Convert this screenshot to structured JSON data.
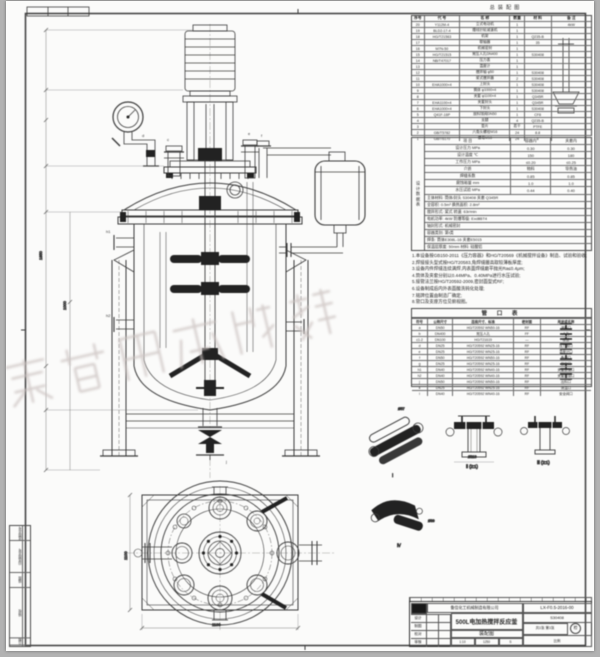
{
  "header": {
    "doc_label": "总装配图"
  },
  "watermark": {
    "text": "威海化工机械",
    "color": "#cbc2c0"
  },
  "left_strip": {
    "rows": [
      "底图总号",
      "旧底图总号",
      "描图",
      "描校",
      "日期"
    ]
  },
  "parts_list": {
    "headers": [
      "序号",
      "代  号",
      "名   称",
      "数量",
      "材 料",
      "备 注"
    ],
    "rows": [
      [
        "20",
        "Y112M-4",
        "立式电动机",
        "1",
        "",
        "4kW"
      ],
      [
        "19",
        "BLD2-17-4",
        "摆线针轮减速机",
        "1",
        "",
        ""
      ],
      [
        "18",
        "HG/T21563",
        "机架",
        "1",
        "Q235-B",
        ""
      ],
      [
        "17",
        "",
        "联轴器",
        "1",
        "35",
        ""
      ],
      [
        "16",
        "M7N-50",
        "机械密封",
        "1",
        "",
        ""
      ],
      [
        "15",
        "HG/T21515",
        "常压人孔DN400",
        "1",
        "S30408",
        ""
      ],
      [
        "14",
        "NB/T47017",
        "压力表",
        "1",
        "",
        ""
      ],
      [
        "13",
        "",
        "温度计",
        "1",
        "",
        ""
      ],
      [
        "12",
        "",
        "搅拌轴 φ50",
        "1",
        "S30408",
        ""
      ],
      [
        "11",
        "",
        "桨式搅拌器",
        "2",
        "S30408",
        ""
      ],
      [
        "10",
        "EHA1000×4",
        "上封头",
        "1",
        "S30408",
        ""
      ],
      [
        "9",
        "",
        "筒体 φ1000×4",
        "1",
        "S30408",
        ""
      ],
      [
        "8",
        "",
        "夹套 φ1100×4",
        "1",
        "Q345R",
        ""
      ],
      [
        "7",
        "EHA1100×4",
        "夹套封头",
        "1",
        "Q345R",
        ""
      ],
      [
        "6",
        "EHA1000×4",
        "下封头",
        "1",
        "S30408",
        ""
      ],
      [
        "5",
        "Q41F-16P",
        "放料球阀DN50",
        "1",
        "CF8",
        ""
      ],
      [
        "4",
        "",
        "支腿",
        "4",
        "Q235-B",
        ""
      ],
      [
        "3",
        "",
        "垫片",
        "若干",
        "PTFE",
        ""
      ],
      [
        "2",
        "GB/T5782",
        "六角头螺栓M16",
        "24",
        "8.8",
        ""
      ],
      [
        "1",
        "GB/T6170",
        "螺母M16",
        "24",
        "8",
        ""
      ]
    ]
  },
  "design_table": {
    "title": "设计数据表",
    "pairs": [
      [
        "项 目",
        "容器内",
        "夹套内"
      ],
      [
        "设计压力 MPa",
        "0.30",
        "0.30"
      ],
      [
        "设计温度 ℃",
        "150",
        "180"
      ],
      [
        "工作压力 MPa",
        "≤0.20",
        "≤0.25"
      ],
      [
        "介质",
        "物料",
        "导热油"
      ],
      [
        "焊缝系数",
        "0.85",
        "0.85"
      ],
      [
        "腐蚀裕量 mm",
        "1.0",
        "1.0"
      ],
      [
        "水压试验 MPa",
        "0.44",
        "0.40"
      ]
    ],
    "lines": [
      "主体材料: 筒体/封头 S30408  夹套 Q345R",
      "全容积: 0.5m³   换热面积: 2.8m²",
      "搅拌形式: 桨式   转速: 63r/min",
      "电机功率: 4kW   防爆等级: ExdⅡBT4",
      "轴封形式: 机械密封",
      "容器类别: 第Ⅰ类",
      "焊条: 筒体E308L-16  夹套E5015",
      "保温层厚度: 50mm  材料: 硅酸铝"
    ]
  },
  "tech_requirements": {
    "lines": [
      "1.本设备按GB150-2011《压力容器》和HG/T20569《机械搅拌设备》制造、试验和验收;",
      "2.焊接接头型式按HG/T20583,角焊缝腰高取较薄板厚度;",
      "3.设备内件焊缝连续满焊,内表面焊缝磨平抛光Ra≤0.4μm;",
      "4.筒体及夹套分别以0.44MPa、0.40MPa进行水压试验;",
      "5.接管法兰按HG/T20592-2009,密封面型式RF;",
      "6.设备制成后内外表面酸洗钝化处理;",
      "7.铭牌位置由制造厂确定;",
      "8.管口及支座方位见俯视图。"
    ]
  },
  "nozzle_table": {
    "title": "管 口 表",
    "headers": [
      "符号",
      "公称尺寸",
      "连接尺寸、标准",
      "密封面",
      "用途或名称"
    ],
    "rows": [
      [
        "a",
        "DN50",
        "HG/T20592 WN50-16",
        "RF",
        "进料口"
      ],
      [
        "b",
        "DN400",
        "常压人孔",
        "FF",
        "人孔"
      ],
      [
        "c1-2",
        "DN100",
        "HG/T21619",
        "—",
        "视镜"
      ],
      [
        "d",
        "DN25",
        "HG/T20592 WN25-16",
        "RF",
        "压力表口"
      ],
      [
        "e",
        "DN25",
        "HG/T20592 WN25-16",
        "RF",
        "温度计口"
      ],
      [
        "f",
        "DN50",
        "HG/T20592 WN50-16",
        "RF",
        "备用口"
      ],
      [
        "g",
        "DN25",
        "HG/T20592 WN25-16",
        "RF",
        "放空口"
      ],
      [
        "h1",
        "DN40",
        "HG/T20592 WN40-16",
        "RF",
        "夹套进油口"
      ],
      [
        "h2",
        "DN40",
        "HG/T20592 WN40-16",
        "RF",
        "夹套出油口"
      ],
      [
        "j",
        "DN50",
        "HG/T20592 WN50-16",
        "RF",
        "出料口"
      ],
      [
        "k",
        "DN25",
        "HG/T20592 WN25-16",
        "RF",
        "测温口"
      ],
      [
        "l",
        "DN40",
        "HG/T20592 WN40-16",
        "RF",
        "安全阀口"
      ]
    ]
  },
  "details": {
    "captions": [
      "Ⅰ",
      "Ⅱ (2:1)",
      "Ⅲ (2:1)",
      "Ⅳ"
    ],
    "dims": [
      "Ø57",
      "Ø219",
      "Ø89"
    ]
  },
  "dims": {
    "front_h": "1850",
    "shell_h": "1000",
    "plan_w": "1100",
    "plan_h": "1100"
  },
  "front_tags": [
    "d",
    "c",
    "e",
    "f",
    "h1",
    "h2",
    "j"
  ],
  "title_block": {
    "company": "鲁信化工机械制造有限公司",
    "product": "500L电加热搅拌反应釜",
    "drawing": "装配图",
    "code": "LX-F0.5-2016-00",
    "material": "S30408",
    "sheet": "共1张 第1张",
    "scale_label": "比例",
    "scale": "1:10",
    "mass_label": "质量",
    "mass": "1250",
    "stage_label": "阶段",
    "stage": "S",
    "stamp": "检",
    "fields": [
      "设计",
      "制图",
      "校对",
      "审核"
    ]
  }
}
